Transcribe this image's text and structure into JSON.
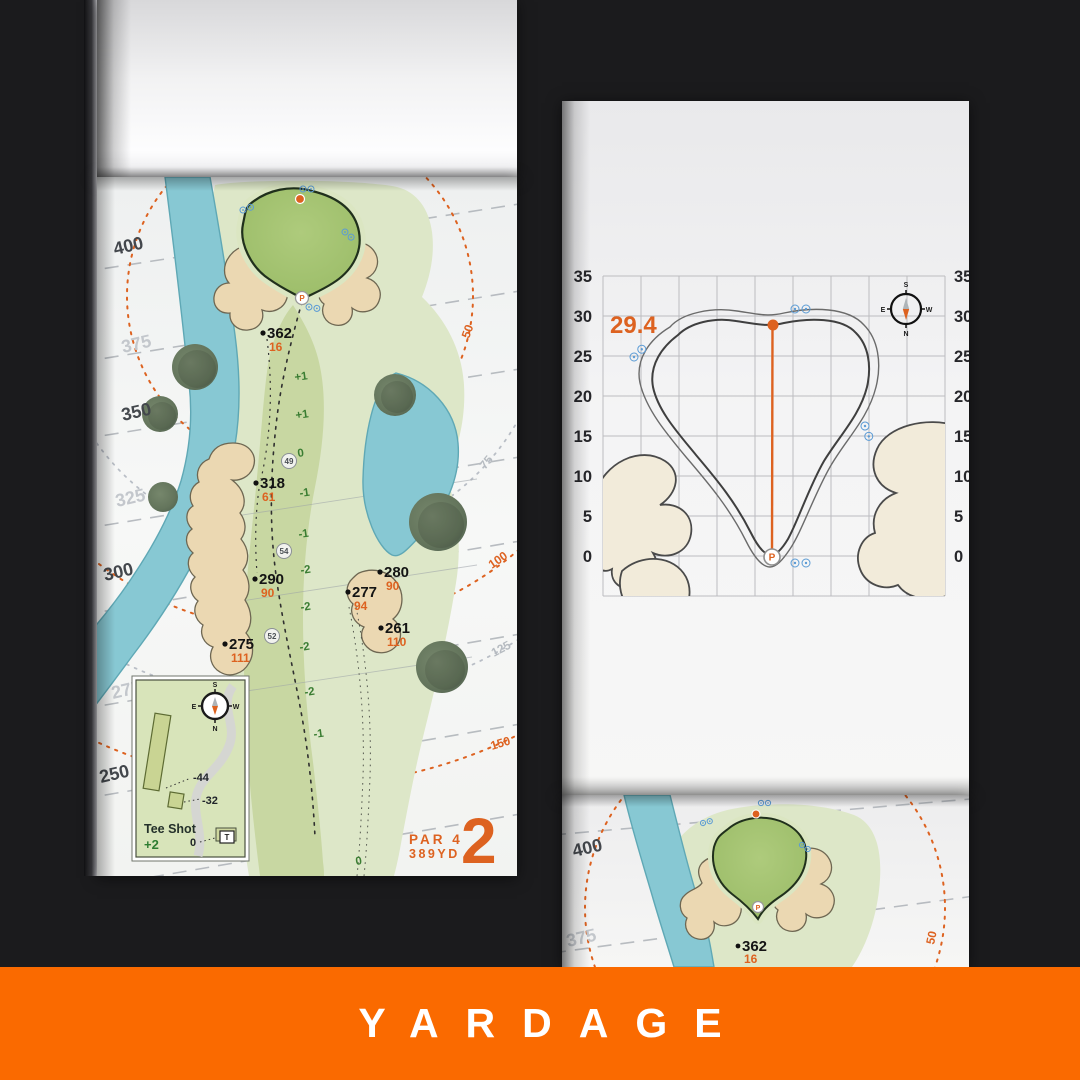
{
  "banner": {
    "label": "YARDAGE"
  },
  "pin_symbol": "P",
  "compass": {
    "n": "N",
    "s": "S",
    "e": "E",
    "w": "W"
  },
  "colors": {
    "background": "#1B1B1D",
    "banner_orange": "#FA6A00",
    "accent_orange": "#DD6220",
    "water_blue": "#87C8D3",
    "fairway_green": "#C8D7A2",
    "putting_green": "#A3C36F",
    "bunker_sand": "#EBD8B2",
    "elevation_green": "#3A7D32",
    "sprinkler_blue": "#5B9BD5"
  },
  "left_page": {
    "hole_number": "2",
    "par": "PAR 4",
    "yardage": "389YD",
    "contour_labels": [
      {
        "text": "400",
        "tone": "dark"
      },
      {
        "text": "375",
        "tone": "light"
      },
      {
        "text": "350",
        "tone": "dark"
      },
      {
        "text": "325",
        "tone": "light"
      },
      {
        "text": "300",
        "tone": "dark"
      },
      {
        "text": "275",
        "tone": "light"
      },
      {
        "text": "250",
        "tone": "dark"
      }
    ],
    "arc_labels": [
      {
        "text": "50",
        "tone": "orange"
      },
      {
        "text": "75",
        "tone": "gray"
      },
      {
        "text": "100",
        "tone": "orange"
      },
      {
        "text": "125",
        "tone": "gray"
      },
      {
        "text": "150",
        "tone": "orange"
      }
    ],
    "markers": [
      {
        "distance": "362",
        "alt": "16"
      },
      {
        "distance": "318",
        "alt": "61"
      },
      {
        "distance": "290",
        "alt": "90"
      },
      {
        "distance": "280",
        "alt": "90"
      },
      {
        "distance": "277",
        "alt": "94"
      },
      {
        "distance": "261",
        "alt": "110"
      },
      {
        "distance": "275",
        "alt": "111"
      }
    ],
    "centerline_values": [
      "+1",
      "+1",
      "0",
      "-1",
      "-1",
      "-2",
      "-2",
      "-2",
      "-2",
      "-1",
      "0"
    ],
    "circled_values": [
      "49",
      "54",
      "52"
    ],
    "inset": {
      "title": "Tee Shot",
      "score": "+2",
      "tee_labels": [
        "-44",
        "-32",
        "0"
      ],
      "tee_symbol": "T"
    }
  },
  "right_page": {
    "depth_value": "29.4",
    "axis_labels": [
      "35",
      "30",
      "25",
      "20",
      "15",
      "10",
      "5",
      "0"
    ]
  },
  "bottom_page": {
    "contour_labels": [
      {
        "text": "400",
        "tone": "dark"
      },
      {
        "text": "375",
        "tone": "light"
      }
    ],
    "arc_label": "50",
    "marker": {
      "distance": "362",
      "alt": "16"
    }
  }
}
